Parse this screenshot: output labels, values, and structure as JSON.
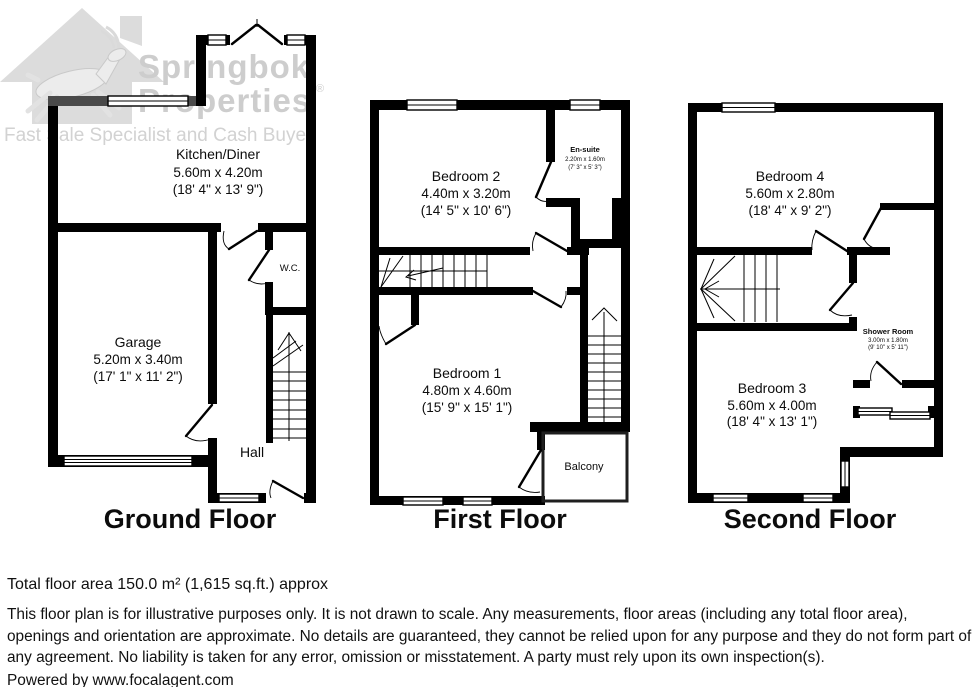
{
  "watermark": {
    "brand_line1": "Springbok",
    "brand_line2": "Properties",
    "registered_mark": "®",
    "tagline": "Fast Sale Specialist and Cash Buyer"
  },
  "floors": {
    "ground": {
      "title": "Ground Floor",
      "rooms": {
        "kitchen": {
          "name": "Kitchen/Diner",
          "metric": "5.60m x 4.20m",
          "imperial": "(18' 4\" x 13' 9\")"
        },
        "garage": {
          "name": "Garage",
          "metric": "5.20m x 3.40m",
          "imperial": "(17' 1\" x 11' 2\")"
        },
        "wc": {
          "name": "W.C."
        },
        "hall": {
          "name": "Hall"
        }
      }
    },
    "first": {
      "title": "First Floor",
      "rooms": {
        "bedroom2": {
          "name": "Bedroom 2",
          "metric": "4.40m x 3.20m",
          "imperial": "(14' 5\" x 10' 6\")"
        },
        "ensuite": {
          "name": "En-suite",
          "metric": "2.20m x 1.60m",
          "imperial": "(7' 3\" x 5' 3\")"
        },
        "bedroom1": {
          "name": "Bedroom 1",
          "metric": "4.80m x 4.60m",
          "imperial": "(15' 9\" x 15' 1\")"
        },
        "balcony": {
          "name": "Balcony"
        }
      }
    },
    "second": {
      "title": "Second Floor",
      "rooms": {
        "bedroom4": {
          "name": "Bedroom 4",
          "metric": "5.60m x 2.80m",
          "imperial": "(18' 4\" x 9' 2\")"
        },
        "shower": {
          "name": "Shower Room",
          "metric": "3.00m x 1.80m",
          "imperial": "(9' 10\" x 5' 11\")"
        },
        "bedroom3": {
          "name": "Bedroom 3",
          "metric": "5.60m x 4.00m",
          "imperial": "(18' 4\" x 13' 1\")"
        }
      }
    }
  },
  "footer": {
    "total_area": "Total floor area 150.0 m² (1,615 sq.ft.) approx",
    "disclaimer": "This floor plan is for illustrative purposes only. It is not drawn to scale. Any measurements, floor areas (including any total floor area), openings and orientation are approximate. No details are guaranteed, they cannot be relied upon for any purpose and they do not form part of any agreement. No liability is taken for any error, omission or misstatement. A party must rely upon its own inspection(s).",
    "powered_by": "Powered by www.focalagent.com"
  },
  "colors": {
    "wall": "#000000",
    "watermark_gray": "#dcdcdc",
    "accent_wall_gray": "#4a4a4a"
  }
}
